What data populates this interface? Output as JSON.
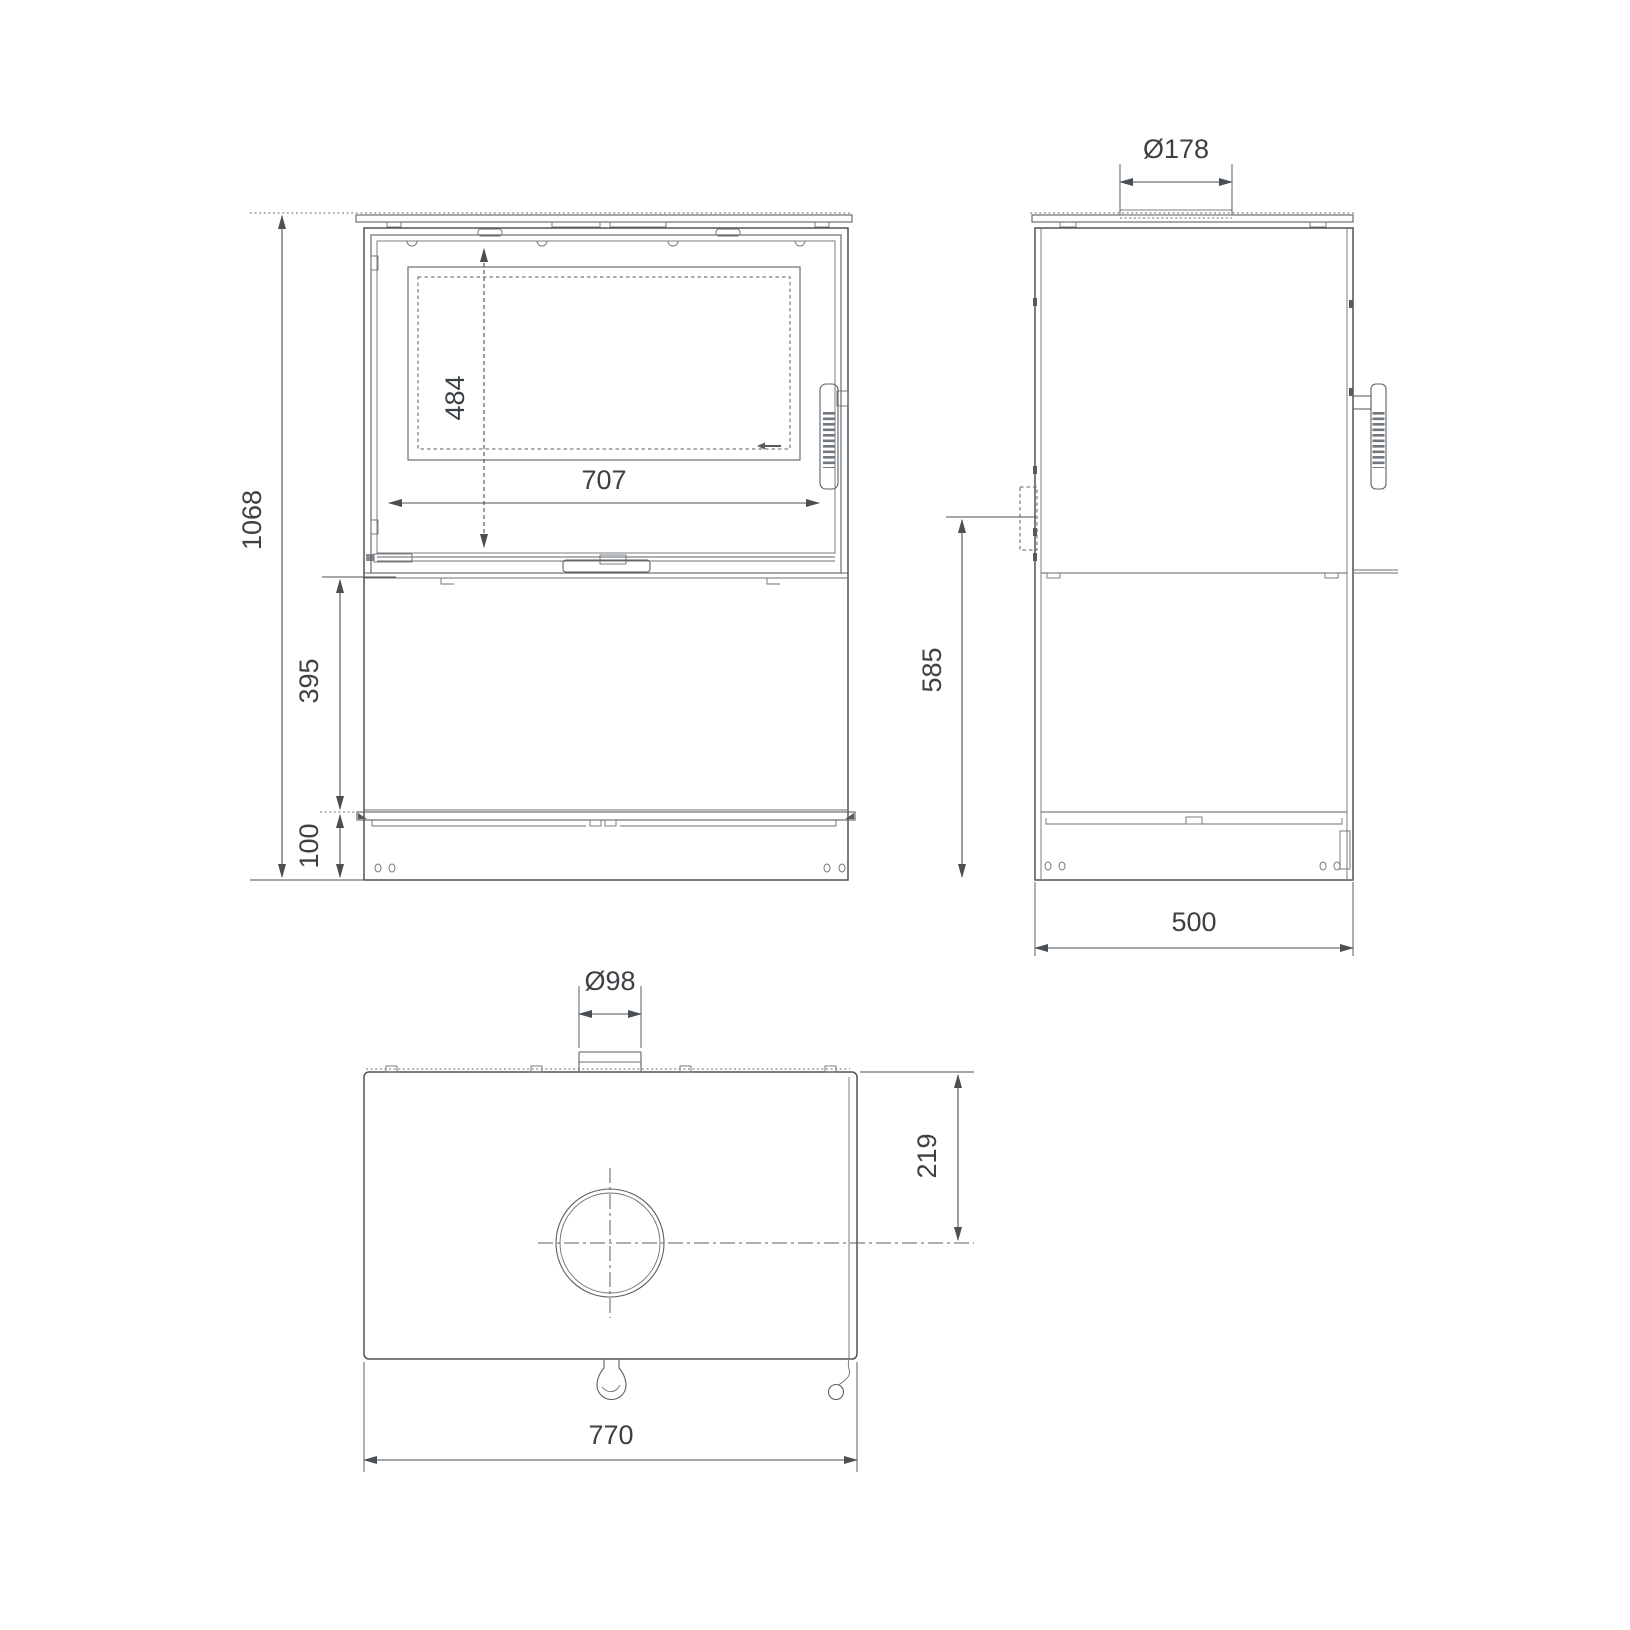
{
  "page": {
    "background": "#ffffff",
    "line_color": "#5a6065",
    "text_color": "#3c4145"
  },
  "drawing": {
    "type": "technical-dimension-drawing",
    "subject": "freestanding stove, three orthographic views",
    "views": [
      {
        "id": "front",
        "name": "front view"
      },
      {
        "id": "side",
        "name": "side view"
      },
      {
        "id": "top",
        "name": "top view"
      }
    ],
    "dimensions": {
      "front": {
        "overall_height": "1068",
        "glass_height": "484",
        "glass_width": "707",
        "lower_panel_height": "395",
        "plinth_height": "100"
      },
      "side": {
        "flue_collar_diameter": "Ø178",
        "damper_axis_height": "585",
        "depth": "500"
      },
      "top": {
        "rear_outlet_diameter": "Ø98",
        "flue_center_from_rear": "219",
        "width": "770"
      }
    }
  }
}
